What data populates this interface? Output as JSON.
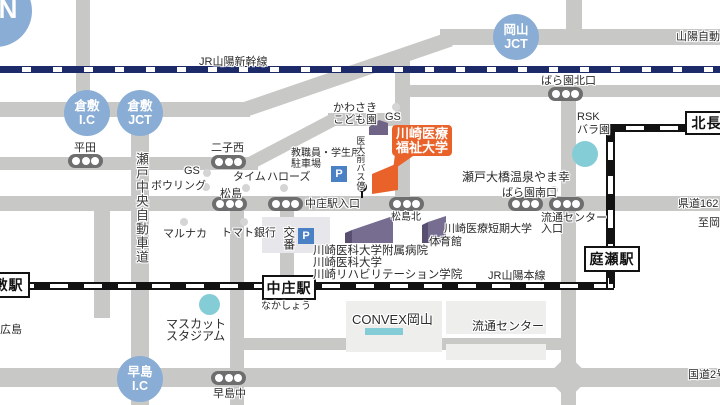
{
  "labels": {
    "compass_n": "N",
    "shinkansen": "JR山陽新幹線",
    "sanyo_expwy": "山陽自動車道",
    "sanyo_line": "JR山陽本線",
    "seto_chuo_expwy": "瀬戸中央自動車道",
    "route2": "国道2号",
    "kendo162": "県道162",
    "to_okayama": "至岡山",
    "hiroshima": "広島",
    "kurashiki_st": "倉敷駅",
    "nakasho_st": "中庄駅",
    "nakasho_kana": "なかしょう",
    "niwase_st": "庭瀬駅",
    "kitanagase_st": "北長瀬",
    "kurashiki_ic_1": "倉敷",
    "kurashiki_ic_2": "I.C",
    "kurashiki_jct_1": "倉敷",
    "kurashiki_jct_2": "JCT",
    "okayama_jct_1": "岡山",
    "okayama_jct_2": "JCT",
    "hayashima_ic_1": "早島",
    "hayashima_ic_2": "I.C",
    "bus_hirata": "平田",
    "bus_futagonishi": "二子西",
    "bus_matsushima": "松島",
    "bus_nakashoeki_iriguchi": "中庄駅入口",
    "bus_matsushima_kita": "松島北",
    "bus_baraen_kitaguchi": "ばら園北口",
    "bus_baraen_minamiguchi": "ばら園南口",
    "bus_ryutsu_iriguchi_1": "流通センター",
    "bus_ryutsu_iriguchi_2": "入口",
    "bus_hayashima_naka": "早島中",
    "kodomoen_1": "かわさき",
    "kodomoen_2": "こども園",
    "gs_top": "GS",
    "gs_left": "GS",
    "bowling": "ボウリング",
    "times": "タイム",
    "hallows": "ハローズ",
    "staff_parking_1": "教職員・学生用",
    "staff_parking_2": "駐車場",
    "marunaka": "マルナカ",
    "tomato_bank": "トマト銀行",
    "koban": "交番",
    "idaimae_bus": "医大前バス停",
    "hospital": "川崎医科大学附属病院",
    "medical_univ": "川崎医科大学",
    "rehab_college": "川崎リハビリテーション学院",
    "junior_college": "川崎医療短期大学",
    "gym": "体育館",
    "yamako_onsen": "瀬戸大橋温泉やま幸",
    "rsk_1": "RSK",
    "rsk_2": "バラ園",
    "muscat_1": "マスカット",
    "muscat_2": "スタジアム",
    "convex": "CONVEX岡山",
    "ryutsu_center": "流通センター",
    "univ_label_1": "川崎医療",
    "univ_label_2": "福祉大学",
    "parking_p": "P"
  },
  "colors": {
    "accent_orange": "#e8622a",
    "ic_blue": "#8aadd5",
    "cyan": "#85cdd6",
    "road_gray": "#c8c9c7",
    "building_purple": "#776d90",
    "shinkansen_navy": "#1c2a6a"
  }
}
